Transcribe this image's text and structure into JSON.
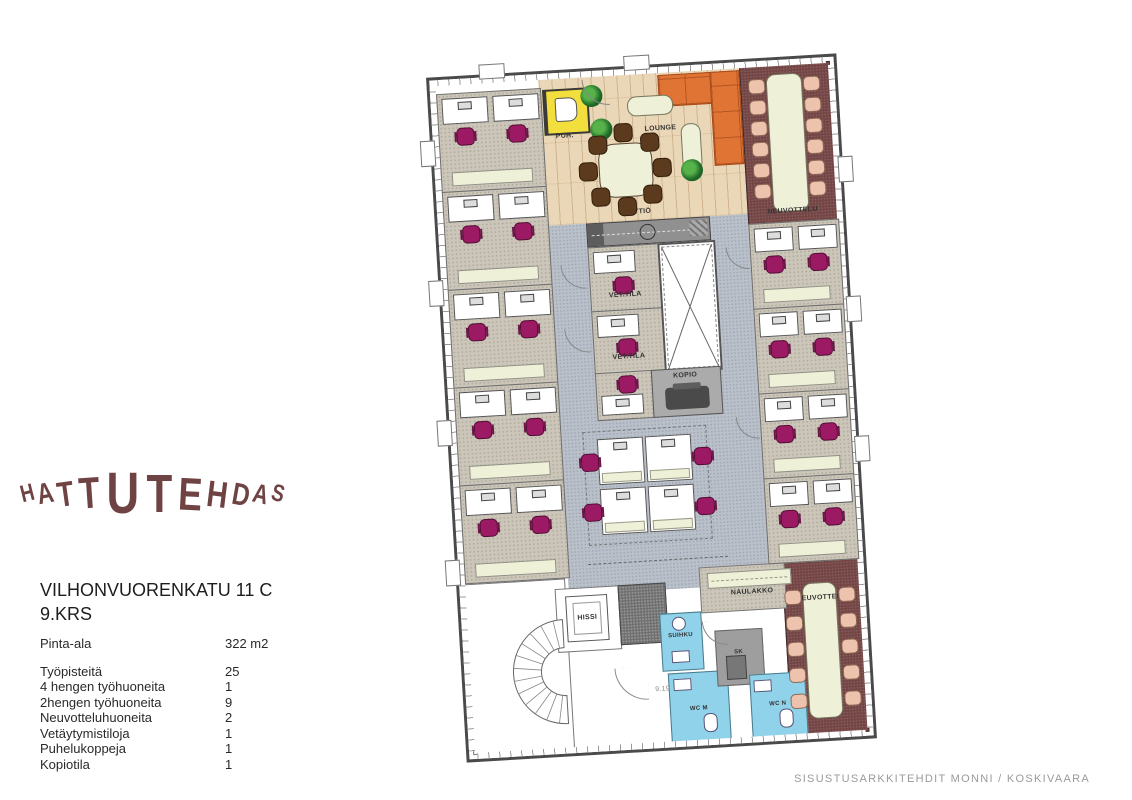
{
  "logo": {
    "text": "HATTUTEHDAS"
  },
  "address": {
    "line1": "VILHONVUORENKATU 11 C",
    "line2": "9.KRS"
  },
  "stats": {
    "area_label": "Pinta-ala",
    "area_value": "322 m2",
    "rows": [
      {
        "label": "Työpisteitä",
        "value": "25"
      },
      {
        "label": "4 hengen työhuoneita",
        "value": "1"
      },
      {
        "label": "2hengen työhuoneita",
        "value": "9"
      },
      {
        "label": "Neuvotteluhuoneita",
        "value": "2"
      },
      {
        "label": "Vetäytymistiloja",
        "value": "1"
      },
      {
        "label": "Puhelukoppeja",
        "value": "1"
      },
      {
        "label": "Kopiotila",
        "value": "1"
      }
    ]
  },
  "footer": {
    "credit": "SISUSTUSARKKITEHDIT MONNI / KOSKIVAARA"
  },
  "plan": {
    "labels": {
      "puh": "PUH.",
      "lounge": "LOUNGE",
      "keittio": "KEITTIÖ",
      "neuvottelu_top": "NEUVOTTELU",
      "vet_tila_1": "VET.TILA",
      "vet_tila_2": "VET.TILA",
      "kopio": "KOPIO",
      "hissi": "HISSI",
      "naulakko": "NAULAKKO",
      "neuvottelu_bottom": "NEUVOTTELU",
      "suihku": "SUIHKU",
      "sk": "SK",
      "wc_m": "WC M",
      "wc_n": "WC N",
      "room_number": "9.19"
    },
    "colors": {
      "office_carpet": "#CBC6B9",
      "open_carpet": "#B9C0CA",
      "wood_floor": "#EAD7B7",
      "meeting_floor": "#744545",
      "sofa_orange": "#DF7434",
      "chair_magenta": "#9C1A63",
      "chair_salmon": "#EEC3AD",
      "chair_brown": "#5C3A1D",
      "furniture_cream": "#EEF0D8",
      "wet_blue": "#8FD2EA",
      "booth_yellow": "#F2DE3C",
      "wall": "#4A4A4A",
      "logo": "#6F4343"
    }
  }
}
